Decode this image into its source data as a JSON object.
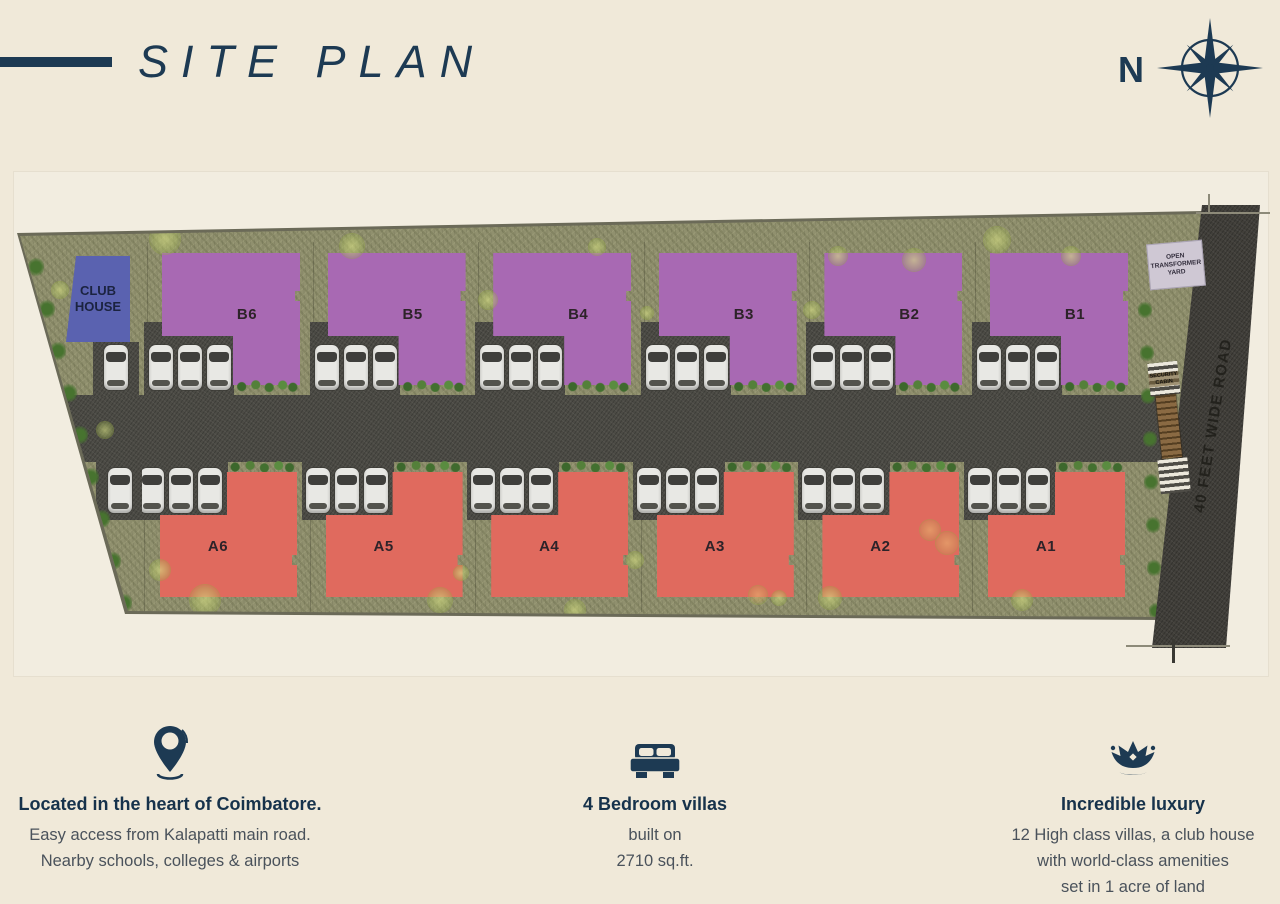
{
  "page": {
    "background": "#f0e9d9",
    "accent": "#1d3a53"
  },
  "header": {
    "title": "SITE PLAN",
    "compass_label": "N"
  },
  "plan": {
    "club_house_label": "CLUB HOUSE",
    "b_villas": [
      "B6",
      "B5",
      "B4",
      "B3",
      "B2",
      "B1"
    ],
    "a_villas": [
      "A6",
      "A5",
      "A4",
      "A3",
      "A2",
      "A1"
    ],
    "road_label": "40 FEET WIDE ROAD",
    "transformer_yard_label": "OPEN TRANSFORMER YARD",
    "security_cabin_label": "SECURITY CABIN",
    "colors": {
      "villa_b": "#a869b3",
      "villa_a": "#e06a5e",
      "club_house": "#5a62b0",
      "grass": "#90906e",
      "asphalt": "#4c4b45",
      "main_road": "#413f3a",
      "transformer_yard": "#cfc8d4",
      "gate": "#8a6a43"
    }
  },
  "features": [
    {
      "icon": "location-pin-icon",
      "heading": "Located in the heart of Coimbatore.",
      "lines": [
        "Easy access from Kalapatti main road.",
        "Nearby schools, colleges & airports"
      ]
    },
    {
      "icon": "bed-icon",
      "heading": "4 Bedroom villas",
      "lines": [
        "built on",
        "2710 sq.ft."
      ]
    },
    {
      "icon": "crown-icon",
      "heading": "Incredible luxury",
      "lines": [
        "12 High class villas, a club house",
        "with world-class amenities",
        "set in 1 acre of land"
      ]
    }
  ]
}
